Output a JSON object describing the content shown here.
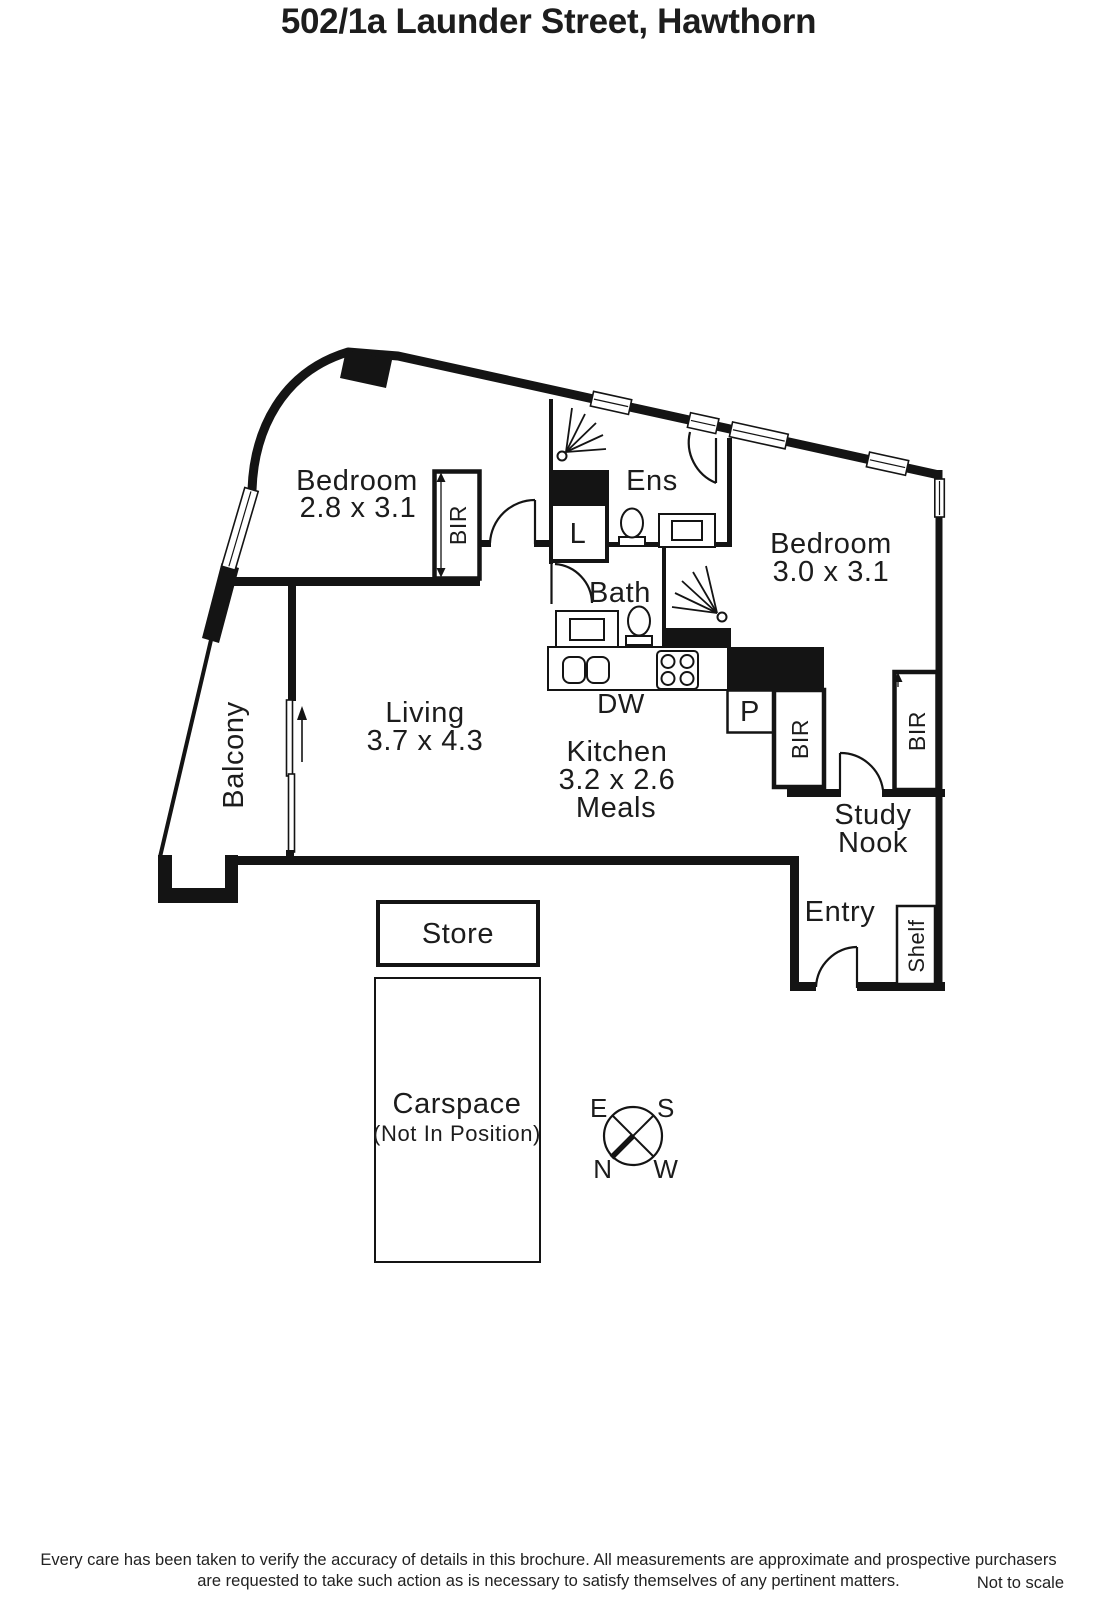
{
  "title": "502/1a Launder Street, Hawthorn",
  "plan": {
    "bedroom1": {
      "name": "Bedroom",
      "dims": "2.8 x 3.1"
    },
    "bedroom2": {
      "name": "Bedroom",
      "dims": "3.0 x 3.1"
    },
    "living": {
      "name": "Living",
      "dims": "3.7 x 4.3"
    },
    "kitchen": {
      "name": "Kitchen",
      "dims": "3.2 x 2.6",
      "sub": "Meals"
    },
    "balcony": {
      "name": "Balcony"
    },
    "ensuite": {
      "name": "Ens"
    },
    "bath": {
      "name": "Bath"
    },
    "laundry": {
      "name": "L"
    },
    "pantry": {
      "name": "P"
    },
    "dishwasher": {
      "name": "DW"
    },
    "robe": {
      "name": "BIR"
    },
    "study_nook": {
      "line1": "Study",
      "line2": "Nook"
    },
    "entry": {
      "name": "Entry"
    },
    "shelf": {
      "name": "Shelf"
    },
    "store": {
      "name": "Store"
    },
    "carspace": {
      "name": "Carspace",
      "note": "(Not In Position)"
    }
  },
  "compass": {
    "east": "E",
    "south": "S",
    "north": "N",
    "west": "W"
  },
  "footer": {
    "disclaimer_line1": "Every care has been taken to verify the accuracy of details in this brochure.  All measurements are approximate and prospective purchasers",
    "disclaimer_line2": "are requested to take such action as is necessary to satisfy themselves of any pertinent matters.",
    "scale_note": "Not to scale"
  },
  "colors": {
    "wall": "#141414",
    "text": "#1c1c1c",
    "background": "#ffffff"
  }
}
